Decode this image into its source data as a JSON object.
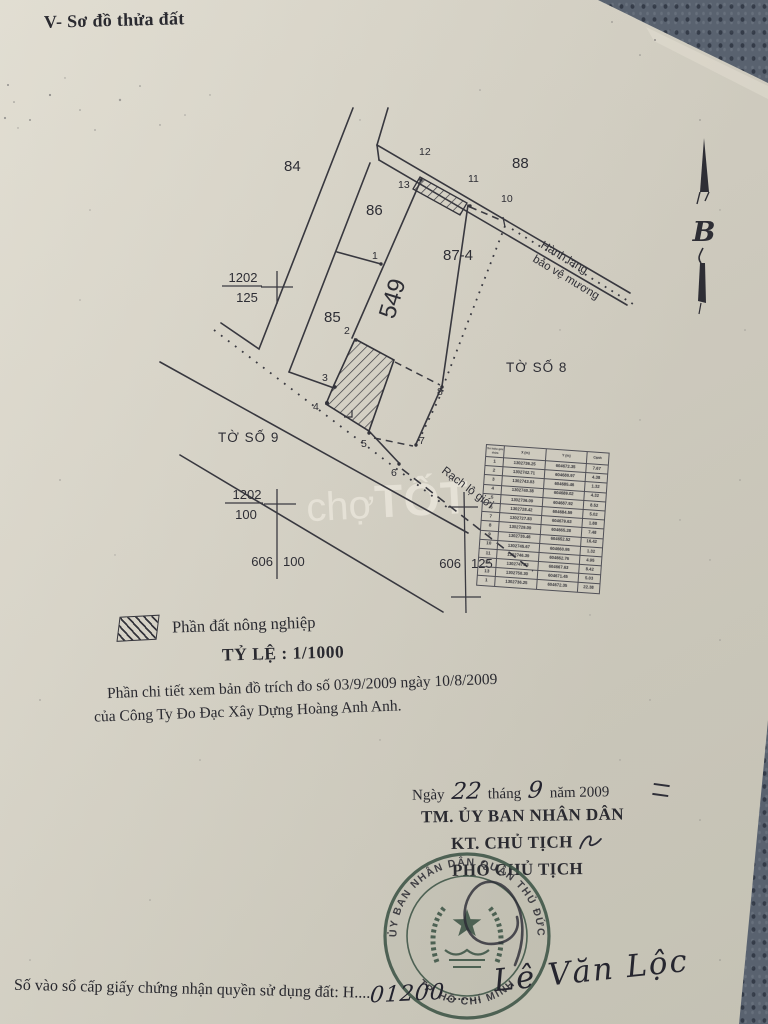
{
  "document": {
    "title": "V- Sơ đồ thửa đất",
    "watermark": {
      "part1": "chợ",
      "part2": "TỐT"
    },
    "compass_label": "B"
  },
  "diagram": {
    "plots": {
      "p84": "84",
      "p88": "88",
      "p86": "86",
      "p85": "85",
      "p87": "87-4",
      "strip": "549"
    },
    "sheets": {
      "to_so_8": "TỜ SỐ 8",
      "to_so_9": "TỜ SỐ 9"
    },
    "corridor_line1": "Hành lang",
    "corridor_line2": "bảo vệ mương",
    "boundary_label": "Rạch lộ giới",
    "vertices": {
      "p1": "1",
      "p2": "2",
      "p3": "3",
      "p4": "4",
      "p5": "5",
      "p6": "6",
      "p7": "7",
      "p8": "8",
      "p10": "10",
      "p11": "11",
      "p12": "12",
      "p13": "13"
    },
    "grid": {
      "f1_num": "1202",
      "f1_den": "125",
      "f2_num": "1202",
      "f2_den": "100",
      "t1_left": "606",
      "t1_right": "100",
      "t2_left": "606",
      "t2_right": "125"
    }
  },
  "coordinate_table": {
    "headers": [
      "Số hiệu góc thửa",
      "X (m)",
      "Y (m)",
      "Cạnh"
    ],
    "rows": [
      [
        "1",
        "1302736.25",
        "604672.35",
        "7.67"
      ],
      [
        "2",
        "1302742.71",
        "604680.97",
        "4.38"
      ],
      [
        "3",
        "1302743.03",
        "604685.46",
        "1.32"
      ],
      [
        "4",
        "1302740.38",
        "604689.02",
        "4.32"
      ],
      [
        "5",
        "1302736.09",
        "604687.92",
        "8.52"
      ],
      [
        "6",
        "1302728.42",
        "604684.59",
        "5.02"
      ],
      [
        "7",
        "1302727.83",
        "604679.63",
        "1.88"
      ],
      [
        "8",
        "1302729.09",
        "604665.28",
        "7.48"
      ],
      [
        "9",
        "1302735.46",
        "604652.52",
        "16.42"
      ],
      [
        "10",
        "1302745.67",
        "604660.95",
        "1.32"
      ],
      [
        "11",
        "1302746.39",
        "604662.76",
        "4.95"
      ],
      [
        "12",
        "1302747.83",
        "604667.63",
        "8.42"
      ],
      [
        "13",
        "1302750.30",
        "604671.45",
        "5.03"
      ],
      [
        "1",
        "1302736.25",
        "604672.35",
        "22.38"
      ]
    ]
  },
  "legend": {
    "label": "Phần đất nông nghiệp",
    "scale": "TỶ LỆ : 1/1000"
  },
  "notes": {
    "line1": "Phần chi tiết xem bản đồ trích đo số 03/9/2009 ngày 10/8/2009",
    "line2": "của Công Ty Đo Đạc Xây Dựng Hoàng Anh Anh."
  },
  "approval": {
    "date_prefix": "Ngày",
    "day": "22",
    "month_label": "tháng",
    "month": "9",
    "year_label": "năm 2009",
    "org": "TM. ỦY BAN NHÂN DÂN",
    "title_kt": "KT. CHỦ TỊCH",
    "title_pho": "PHÓ CHỦ TỊCH",
    "signer": "Lê Văn Lộc",
    "stamp_arc_top": "ỦY BAN NHÂN DÂN QUẬN THỦ ĐỨC",
    "stamp_arc_bottom": "TP. HỒ CHÍ MINH"
  },
  "footer": {
    "label": "Số vào sổ cấp giấy chứng nhận quyền sử dụng đất: H....",
    "number": "01200",
    "dots": "........."
  }
}
